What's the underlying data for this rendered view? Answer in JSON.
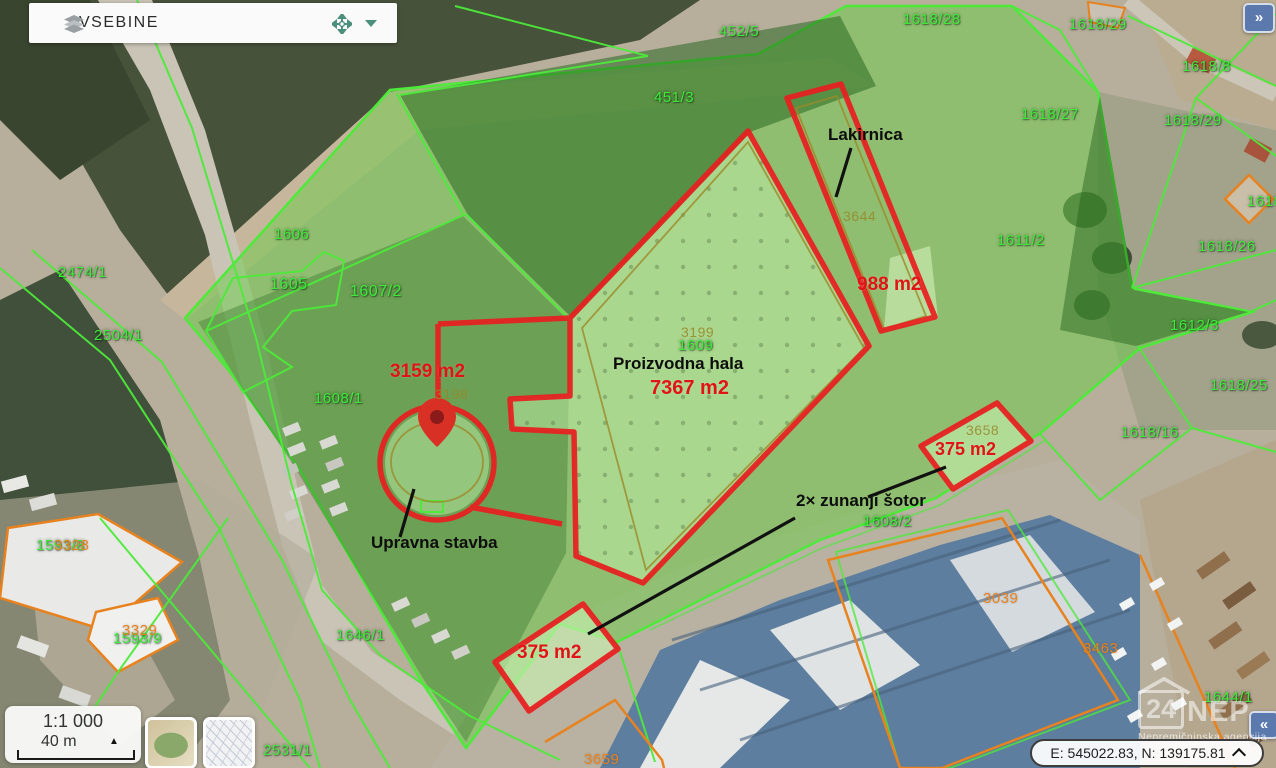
{
  "panel": {
    "title": "VSEBINE"
  },
  "collapse_button": {
    "label": "»"
  },
  "expand_button": {
    "label": "«"
  },
  "scale": {
    "ratio": "1:1 000",
    "distance": "40 m",
    "expand_arrow": "▲"
  },
  "coordinates": {
    "value": "E: 545022.83, N: 139175.81"
  },
  "watermark": {
    "brand_left": "24",
    "brand_right": "NEP",
    "subtitle": "Nepremičninska agencija"
  },
  "map": {
    "callouts": [
      {
        "text": "Lakirnica",
        "x": 828,
        "y": 126
      },
      {
        "text": "Proizvodna hala",
        "x": 613,
        "y": 355
      },
      {
        "text": "Upravna stavba",
        "x": 371,
        "y": 534
      },
      {
        "text": "2× zunanji šotor",
        "x": 796,
        "y": 492
      }
    ],
    "area_labels": [
      {
        "text": "988 m2",
        "x": 857,
        "y": 275,
        "size": 19
      },
      {
        "text": "7367 m2",
        "x": 650,
        "y": 378,
        "size": 20
      },
      {
        "text": "3159 m2",
        "x": 390,
        "y": 362,
        "size": 19
      },
      {
        "text": "375 m2",
        "x": 935,
        "y": 440,
        "size": 18
      },
      {
        "text": "375 m2",
        "x": 517,
        "y": 643,
        "size": 19
      }
    ],
    "parcel_labels": [
      {
        "text": "452/5",
        "x": 719,
        "y": 24
      },
      {
        "text": "451/3",
        "x": 654,
        "y": 90
      },
      {
        "text": "1618/28",
        "x": 903,
        "y": 12
      },
      {
        "text": "1618/29",
        "x": 1069,
        "y": 17
      },
      {
        "text": "1618/8",
        "x": 1182,
        "y": 59
      },
      {
        "text": "1618/29",
        "x": 1164,
        "y": 113
      },
      {
        "text": "1618/27",
        "x": 1021,
        "y": 107
      },
      {
        "text": "1611/2",
        "x": 997,
        "y": 233
      },
      {
        "text": "1618",
        "x": 1247,
        "y": 194
      },
      {
        "text": "1618/26",
        "x": 1198,
        "y": 239
      },
      {
        "text": "1612/3",
        "x": 1170,
        "y": 318
      },
      {
        "text": "1618/25",
        "x": 1210,
        "y": 378
      },
      {
        "text": "1618/16",
        "x": 1121,
        "y": 425
      },
      {
        "text": "2474/1",
        "x": 58,
        "y": 265
      },
      {
        "text": "2504/1",
        "x": 94,
        "y": 328
      },
      {
        "text": "1606",
        "x": 274,
        "y": 227
      },
      {
        "text": "1605",
        "x": 270,
        "y": 277,
        "size": 16
      },
      {
        "text": "1607/2",
        "x": 350,
        "y": 284,
        "size": 16
      },
      {
        "text": "1608/1",
        "x": 314,
        "y": 391
      },
      {
        "text": "1609",
        "x": 678,
        "y": 338
      },
      {
        "text": "1608/2",
        "x": 863,
        "y": 514
      },
      {
        "text": "1646/1",
        "x": 336,
        "y": 628
      },
      {
        "text": "2531/1",
        "x": 263,
        "y": 743
      },
      {
        "text": "1644/1",
        "x": 1204,
        "y": 690
      },
      {
        "text": "1593/8",
        "x": 36,
        "y": 538
      },
      {
        "text": "1593/9",
        "x": 113,
        "y": 631
      }
    ],
    "building_labels": [
      {
        "text": "3199",
        "x": 681,
        "y": 325
      },
      {
        "text": "3644",
        "x": 843,
        "y": 209
      },
      {
        "text": "3658",
        "x": 966,
        "y": 423
      },
      {
        "text": "3198",
        "x": 435,
        "y": 387
      }
    ],
    "orange_labels": [
      {
        "text": "3328",
        "x": 54,
        "y": 538
      },
      {
        "text": "3329",
        "x": 122,
        "y": 623
      },
      {
        "text": "3039",
        "x": 983,
        "y": 591
      },
      {
        "text": "3659",
        "x": 584,
        "y": 752
      },
      {
        "text": "3463",
        "x": 1083,
        "y": 641
      }
    ],
    "colors": {
      "selection_fill": "#69cd46",
      "parcel_line": "#4dea3a",
      "annotation_red": "#e62222",
      "building_outline_olive": "#9b8a28",
      "building_outline_orange": "#e8821e",
      "accent_teal": "#4c8f7d",
      "button_blue": "#5b79ad"
    }
  }
}
